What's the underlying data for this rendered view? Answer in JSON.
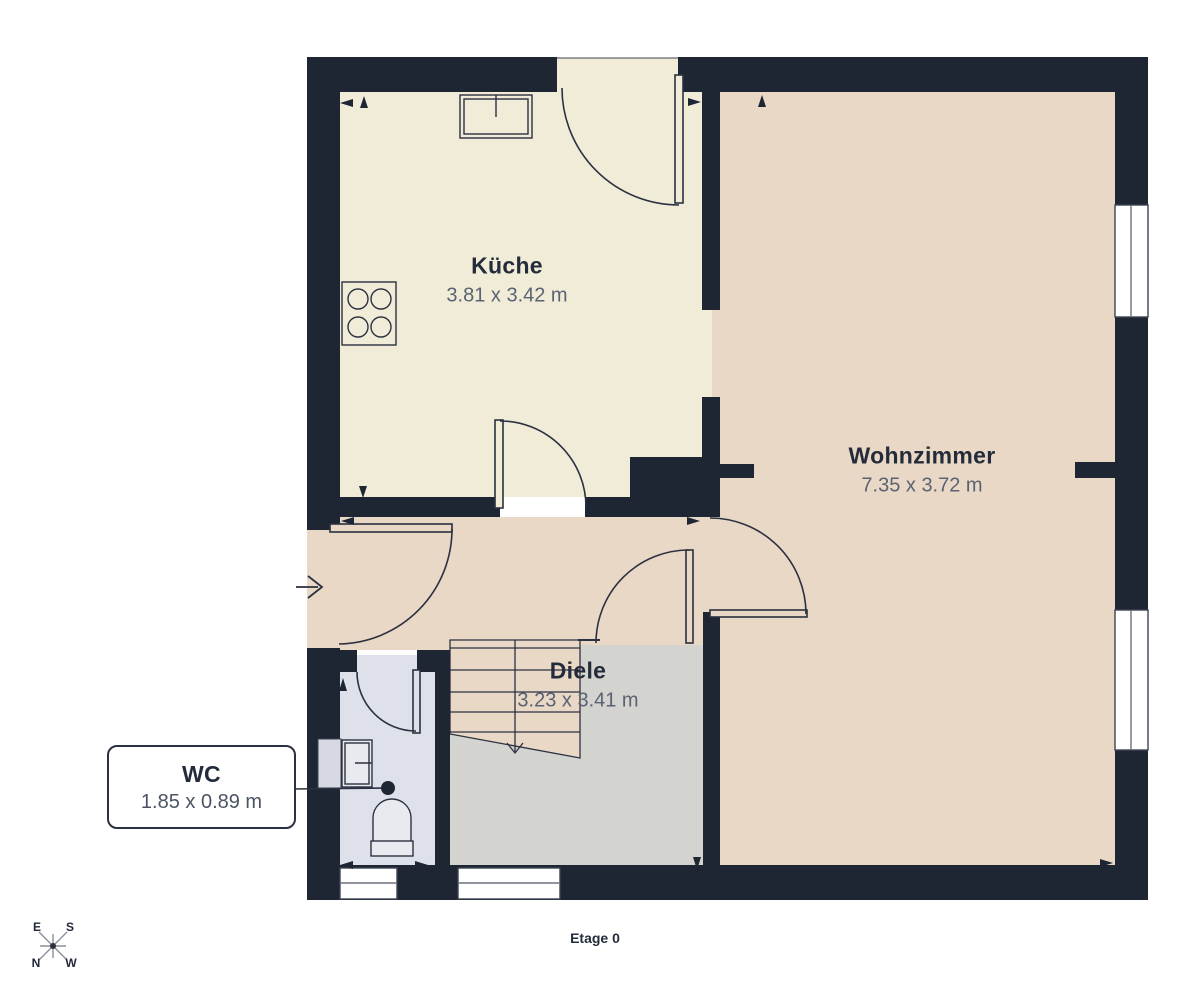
{
  "floor_label": "Etage 0",
  "rooms": [
    {
      "name": "Küche",
      "dims": "3.81 x 3.42 m"
    },
    {
      "name": "Wohnzimmer",
      "dims": "7.35 x 3.72 m"
    },
    {
      "name": "Diele",
      "dims": "3.23 x 3.41 m"
    },
    {
      "name": "WC",
      "dims": "1.85 x 0.89 m"
    }
  ],
  "compass": {
    "east": "E",
    "south": "S",
    "north": "N",
    "west": "W"
  },
  "palette": {
    "wall": "#1e2533",
    "kitchen_floor": "#f1ecd8",
    "living_floor": "#e9d8c6",
    "hall_gray": "#d3d3d0",
    "wc_floor": "#dee1ea",
    "outline": "#2b3140",
    "label_dark": "#242b3a",
    "dims_gray": "#5a6372",
    "window_white": "#ffffff"
  }
}
